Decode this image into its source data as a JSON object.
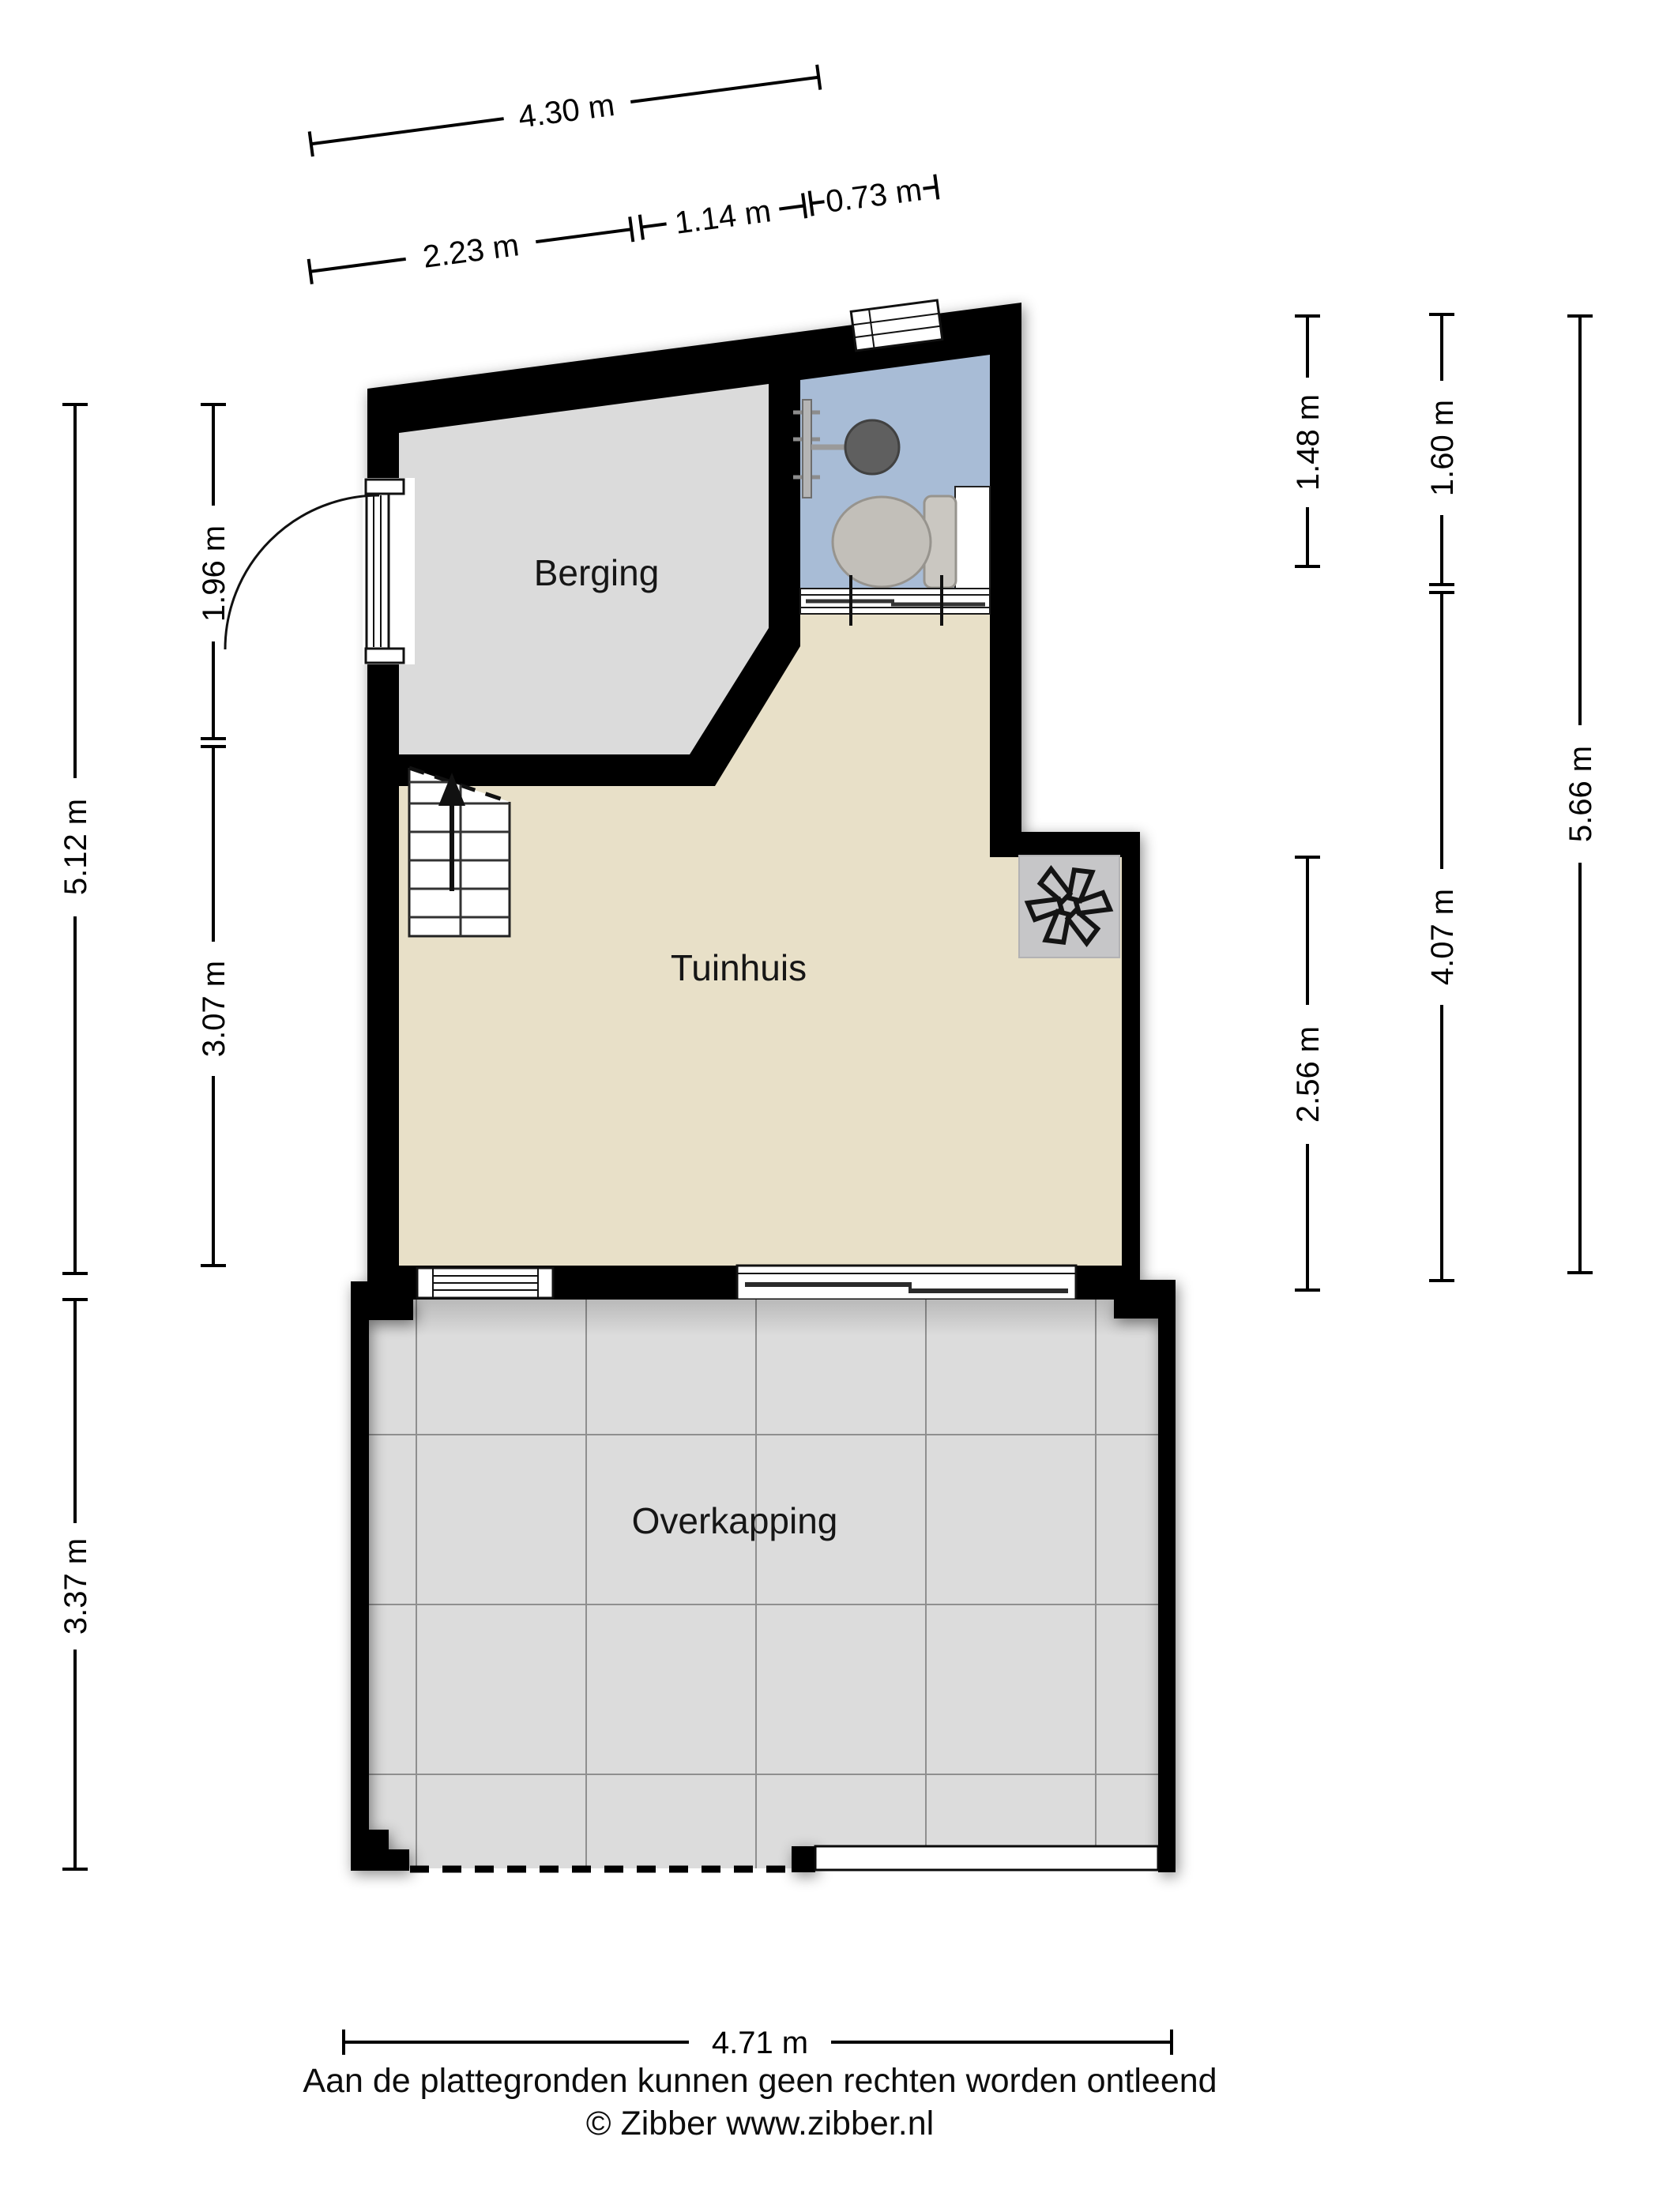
{
  "title": "Plattegrond tuinhuis",
  "rooms": {
    "berging": "Berging",
    "tuinhuis": "Tuinhuis",
    "overkapping": "Overkapping"
  },
  "dimensions": {
    "top_total": "4.30 m",
    "top_left": "2.23 m",
    "top_mid": "1.14 m",
    "top_right": "0.73 m",
    "left_inner_upper": "1.96 m",
    "left_outer_upper": "5.12 m",
    "left_inner_lower": "3.07 m",
    "left_outer_lower": "3.37 m",
    "right_inner_upper": "1.48 m",
    "right_mid_upper": "1.60 m",
    "right_outer": "5.66 m",
    "right_mid_lower": "4.07 m",
    "right_inner_lower": "2.56 m",
    "bottom_total": "4.71 m"
  },
  "icons": {
    "shower": "shower-icon",
    "toilet": "toilet-icon",
    "stove_fan": "stove-fan-icon",
    "stairs_arrow": "stairs-up-arrow-icon",
    "door_swing": "door-swing-arc",
    "sliding_door_arrow": "sliding-door-arrow-icon"
  },
  "colors": {
    "wall": "#000000",
    "berging_floor": "#dbdbdb",
    "tuinhuis_floor": "#e8e0c8",
    "bathroom_floor": "#a8bcd6",
    "terrace_tile": "#dcdcdc",
    "stove_plate": "#c6c6c8",
    "stairs": "#ffffff"
  },
  "footer": {
    "disclaimer": "Aan de plattegronden kunnen geen rechten worden ontleend",
    "credit": "© Zibber www.zibber.nl"
  }
}
